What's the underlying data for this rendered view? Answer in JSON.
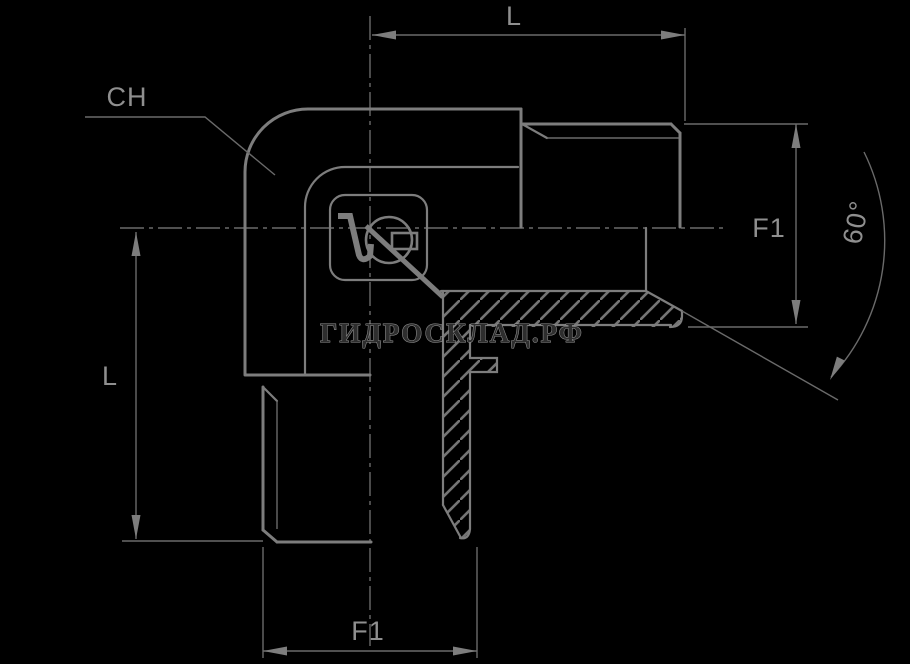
{
  "page": {
    "background": "#000000"
  },
  "drawing": {
    "description": "Technical drawing of a 90-degree elbow hydraulic adapter with two male threaded ports shown in half-section",
    "line_color": "#7d7d7d",
    "thin_line_color": "#6a6a6a",
    "label_color": "#8f8f8f",
    "labels": {
      "top_length": "L",
      "left_length": "L",
      "wrench_size": "CH",
      "right_thread": "F1",
      "bottom_thread": "F1",
      "cone_angle": "60°"
    },
    "watermark": {
      "text": "ГИДРОСКЛАД.РФ",
      "fill": "#2e2e2e",
      "stroke": "#9a9a9a"
    }
  }
}
